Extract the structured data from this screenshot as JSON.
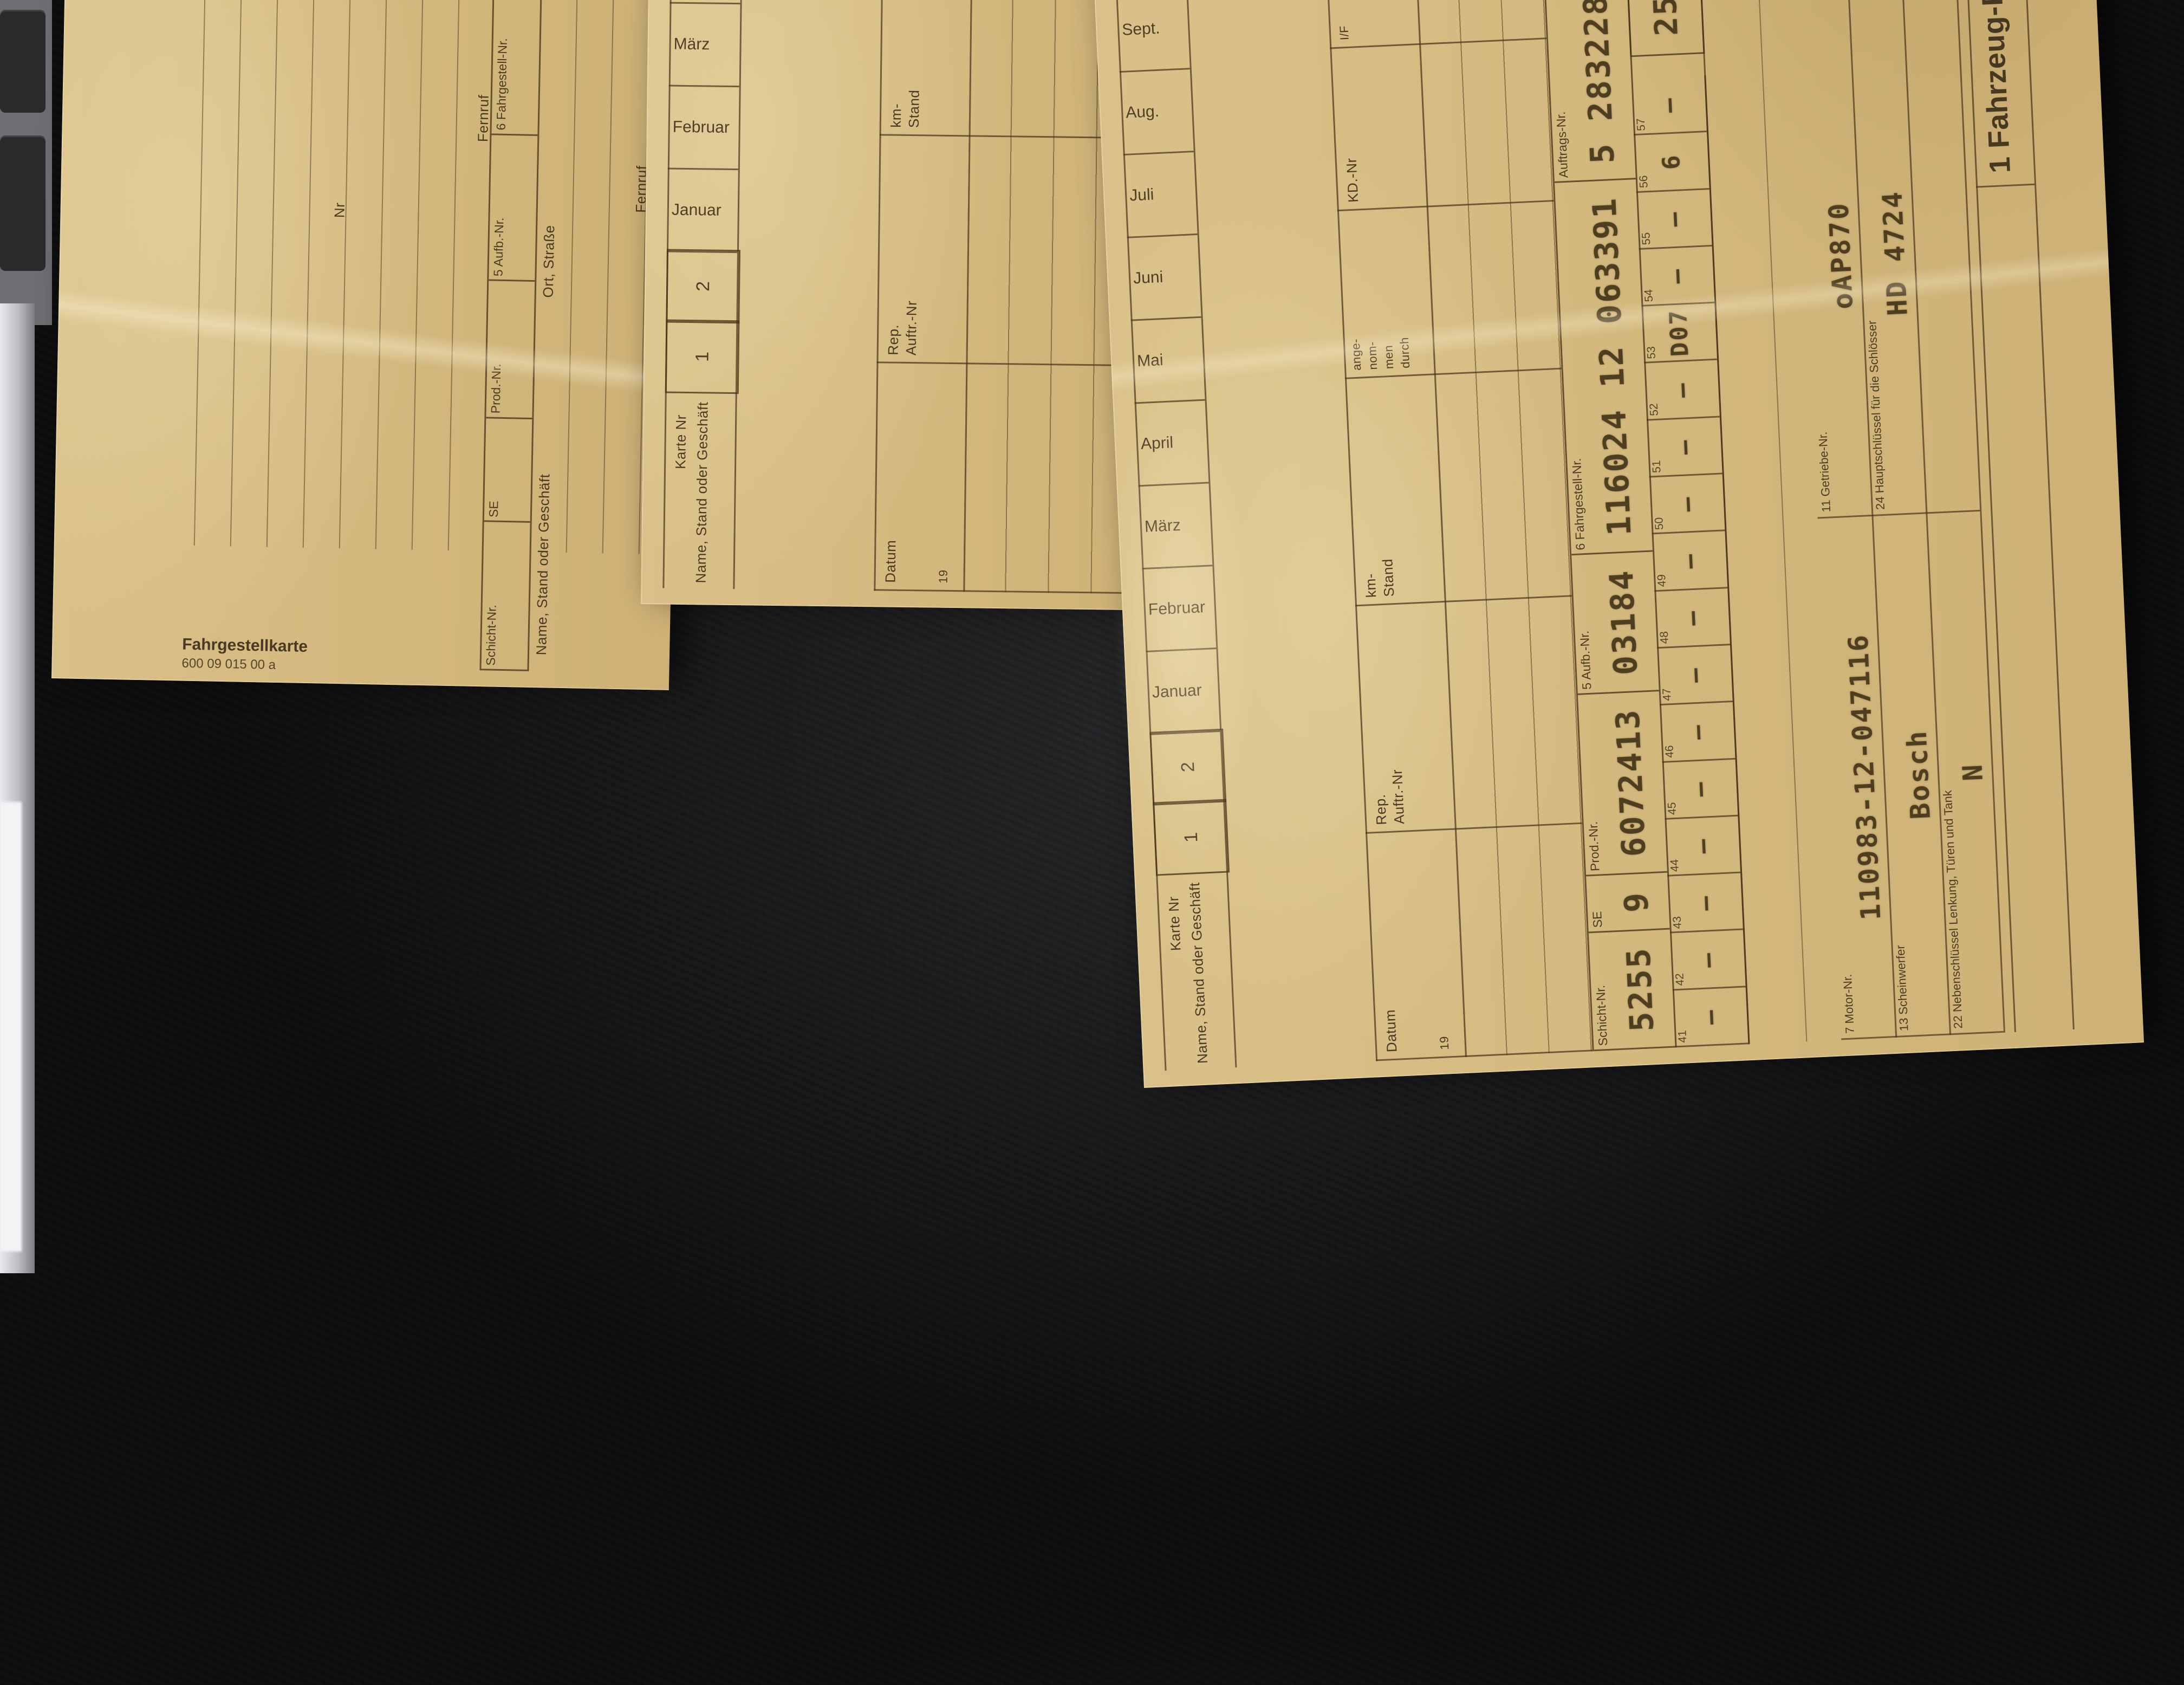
{
  "scene": {
    "surface": "dark fabric table",
    "accent_red": "#b8402c",
    "paper_color": "#d6bc83"
  },
  "shared": {
    "months": [
      "Januar",
      "Februar",
      "März",
      "April",
      "Mai",
      "Juni",
      "Juli",
      "Aug.",
      "Sept.",
      "Okt.",
      "Nov.",
      "Dez."
    ],
    "service": {
      "datum": "Datum",
      "datum_sub": "19",
      "rep": "Rep.",
      "rep2": "Auftr.-Nr",
      "km": "km-",
      "km2": "Stand",
      "ange": "ange-",
      "nom": "nom-",
      "men": "men",
      "durch": "durch",
      "kd": "KD.-Nr",
      "if": "I/F",
      "r": "R",
      "u": "U",
      "oel": "Ölwechsel",
      "reparatur": "Reparatur",
      "unfall": "Unfall",
      "bemerkungen": "Bemerkungen"
    }
  },
  "cards": {
    "left": {
      "form_number": "600 09 015 00 a",
      "form_name": "Fahrgestellkarte",
      "fahrgestell_end": "Fahrgestell-End-Nr",
      "pol": "Pol.-Nr",
      "verkauf1": "Verkauf lt.",
      "verkauf2": "Zulassungsliste vom",
      "an": "an",
      "nr": "Nr",
      "beruf": "Beruf",
      "ort": "Ort",
      "strasse": "Straße",
      "fernruf": "Fernruf",
      "tel": "Tel.-Nr",
      "schicht_labels": [
        {
          "label": "Schicht-Nr.",
          "value": ""
        },
        {
          "label": "SE",
          "value": ""
        },
        {
          "label": "Prod.-Nr.",
          "value": ""
        },
        {
          "label": "5 Aufb.-Nr.",
          "value": ""
        },
        {
          "label": "6 Fahrgestell-Nr.",
          "value": ""
        },
        {
          "label": "Auftrags-Nr.",
          "value": ""
        },
        {
          "label": "7 UT  Lack  OT",
          "value": ""
        },
        {
          "label": "8 Ausst.",
          "value": ""
        },
        {
          "label": "40",
          "value": ""
        },
        {
          "label": "41",
          "value": ""
        },
        {
          "label": "42",
          "value": ""
        },
        {
          "label": "43",
          "value": ""
        }
      ],
      "bottom_name": "Name, Stand oder Geschäft",
      "bottom_ort": "Ort, Straße",
      "bottom_strasse": "Fernruf",
      "bottom_bemerkungen": "Bemerkungen"
    },
    "middle": {
      "karte_nr": "Karte Nr",
      "box1": "1",
      "box2": "2",
      "konto": "Konto-Nr",
      "pol": "Pol.-Nr",
      "name": "Name, Stand oder Geschäft",
      "ort": "Ort, Straße",
      "tel": "Tel.-Nr",
      "typ": "Typ",
      "massgebend": "maßgebend",
      "bemerkungen": "Bemerkungen"
    },
    "right": {
      "karte_nr": "Karte Nr",
      "box1": "1",
      "box2": "2",
      "konto": "Konto-Nr",
      "pol": "Pol.-Nr",
      "name": "Name, Stand oder Geschäft",
      "ort": "Ort, Straße",
      "tel": "Tel.-Nr",
      "typ": "Typ",
      "massgebend": "maßgebend",
      "bemerkungen": "Bemerkungen",
      "schicht_row": [
        {
          "label": "Schicht-Nr.",
          "value": "5255"
        },
        {
          "label": "SE",
          "value": "9"
        },
        {
          "label": "Prod.-Nr.",
          "value": "6072413"
        },
        {
          "label": "5 Aufb.-Nr.",
          "value": "03184"
        },
        {
          "label": "6 Fahrgestell-Nr.",
          "value": "116024 12 063391"
        },
        {
          "label": "Auftrags-Nr.",
          "value": "5 28322871"
        },
        {
          "label": "7 UT  Lack  OT",
          "value": "861 —"
        },
        {
          "label": "8 Ausst.",
          "value": "005"
        },
        {
          "label": "40",
          "value": "1"
        },
        {
          "label": "41",
          "value": "—"
        },
        {
          "label": "42",
          "value": "0"
        },
        {
          "label": "43",
          "value": "—"
        }
      ],
      "small_boxes": [
        {
          "n": "41",
          "v": "—"
        },
        {
          "n": "42",
          "v": "—"
        },
        {
          "n": "43",
          "v": "—"
        },
        {
          "n": "44",
          "v": "—"
        },
        {
          "n": "45",
          "v": "—"
        },
        {
          "n": "46",
          "v": "—"
        },
        {
          "n": "47",
          "v": "—"
        },
        {
          "n": "48",
          "v": "—"
        },
        {
          "n": "49",
          "v": "—"
        },
        {
          "n": "50",
          "v": "—"
        },
        {
          "n": "51",
          "v": "—"
        },
        {
          "n": "52",
          "v": "—"
        },
        {
          "n": "53",
          "v": "D07"
        },
        {
          "n": "54",
          "v": "—"
        },
        {
          "n": "55",
          "v": "—"
        },
        {
          "n": "56",
          "v": "6"
        },
        {
          "n": "57",
          "v": "—"
        }
      ],
      "km_value_1": "258",
      "km_value_2": "835",
      "wenig": "wenig gebraucht",
      "hinweis": "Hinweis",
      "tail_dashes": "— — —",
      "fahrzeug": {
        "title": "1 Fahrzeug-Daten",
        "code": "35",
        "row1": [
          {
            "label": "7 Motor-Nr.",
            "value": "110983-12-047116"
          },
          {
            "label": "11 Getriebe-Nr.",
            "value": "oAP870"
          },
          {
            "label": "4 Typ",
            "value": "280 SE"
          }
        ],
        "row2": [
          {
            "label": "13 Scheinwerfer",
            "value": "Bosch"
          },
          {
            "label": "24 Hauptschlüssel für die Schlösser",
            "value": "HD  4724"
          },
          {
            "label": "19 Bereifung Fabrikat",
            "value": "Mich."
          }
        ],
        "row3": [
          {
            "label": "22 Nebenschlüssel Lenkung, Türen und Tank",
            "value": "N"
          },
          {
            "label": "",
            "value": ""
          },
          {
            "label": "",
            "value": ""
          }
        ]
      },
      "red_marks": "red crayon strokes"
    }
  }
}
